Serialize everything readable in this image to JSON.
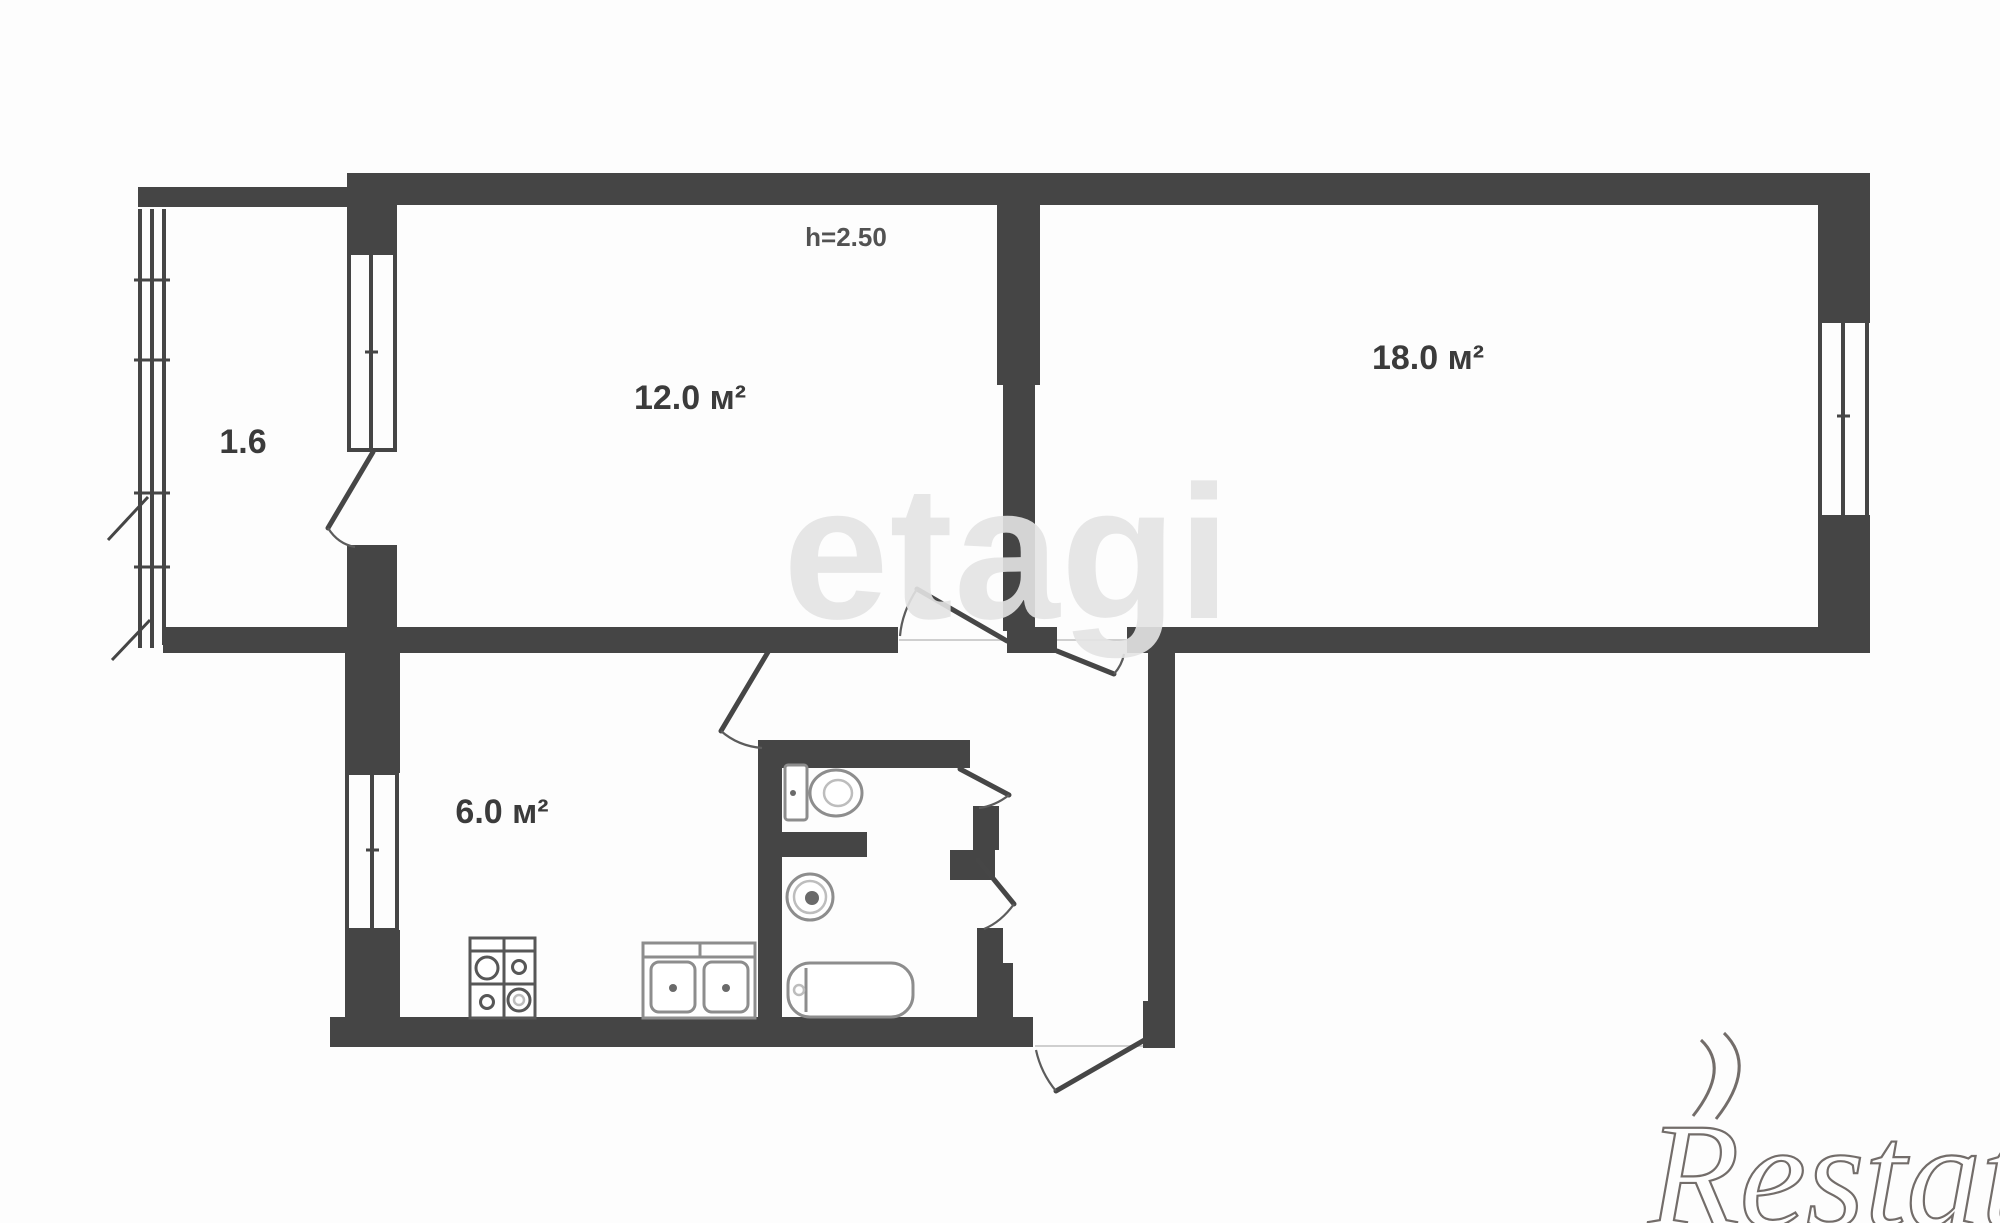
{
  "plan": {
    "rooms": [
      {
        "name": "balcony",
        "label": "1.6"
      },
      {
        "name": "living-room",
        "label": "12.0 м²"
      },
      {
        "name": "bedroom",
        "label": "18.0 м²"
      },
      {
        "name": "kitchen",
        "label": "6.0 м²"
      }
    ],
    "ceiling_height": "h=2.50",
    "fixtures": [
      "stove-icon",
      "kitchen-sink-icon",
      "toilet-icon",
      "washbasin-icon",
      "bathtub-icon"
    ]
  },
  "watermarks": {
    "brand_center": "etagi",
    "brand_corner": "Restate"
  },
  "colors": {
    "wall": "#454545",
    "fixture_outline": "#8d8d8d",
    "label_text": "#3b3b3b",
    "watermark_center": "#e3e3e3",
    "watermark_corner": "#736d6a",
    "background": "#fdfdfd"
  }
}
